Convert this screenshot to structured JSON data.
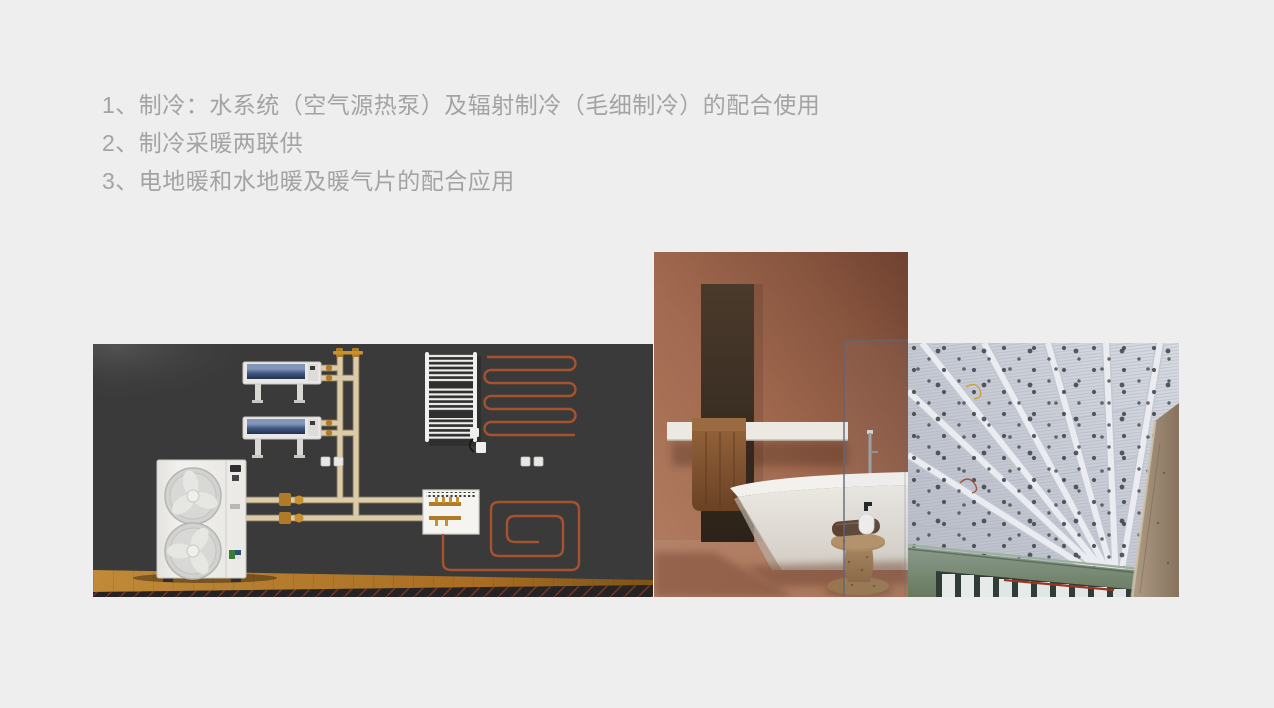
{
  "slide": {
    "background_color": "#eeeeee",
    "text_color": "#a3a3a3",
    "bullets": [
      "1、制冷：水系统（空气源热泵）及辐射制冷（毛细制冷）的配合使用",
      "2、制冷采暖两联供",
      "3、电地暖和水地暖及暖气片的配合应用"
    ]
  },
  "figures": {
    "hvac_system_render": {
      "palette": {
        "wall": "#3a3a3a",
        "floor_wood": "#b5762a",
        "pipe_beige": "#dbcba9",
        "heating_coil_orange": "#a6522f",
        "equipment_white": "#efeeec",
        "fan_coil_blue": "#2c3c5c",
        "brass_fitting": "#b07b26"
      }
    },
    "bathroom_photo": {
      "palette": {
        "wall_terracotta": "#a76e54",
        "recess_dark": "#3a2d22",
        "tub_white": "#ece9e4",
        "floor": "#b5836a",
        "stool_cork": "#a5825c"
      }
    },
    "capillary_ceiling_photo": {
      "palette": {
        "ceiling_mat": "#c9cdd6",
        "beam_white": "#e9ebef",
        "wall_green": "#7c8f80",
        "column_concrete": "#9c8874",
        "window_frame": "#31413a"
      }
    }
  }
}
